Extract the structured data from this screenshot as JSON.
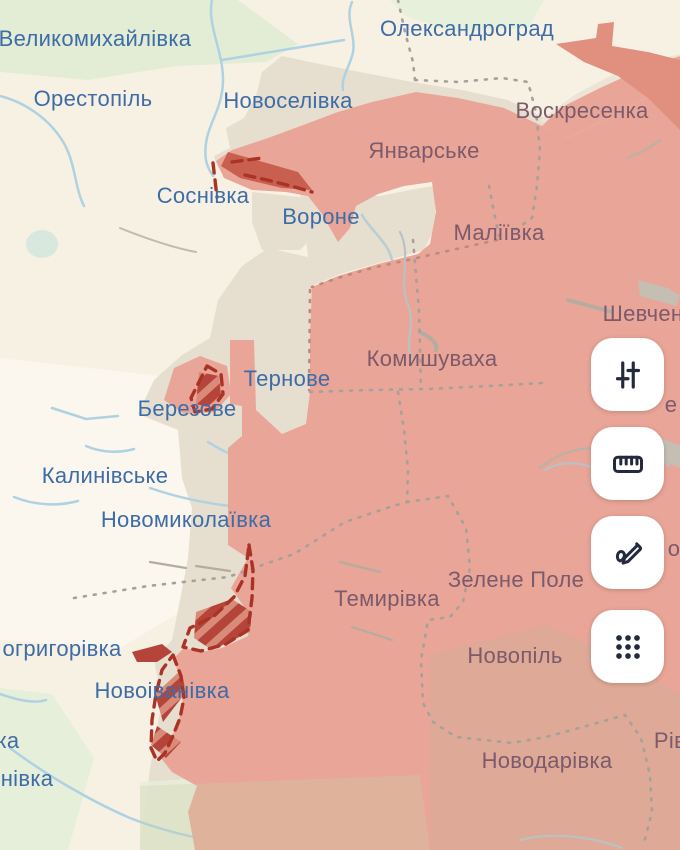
{
  "theme": {
    "cream": "#f7f1e4",
    "occupied-fill": "#e9a597",
    "occupied-dark": "#e19080",
    "advance-red": "#c9604f",
    "hatch-red": "#b5453a",
    "frontline-red": "#aa3226",
    "grey-zone": "#e6decf",
    "admin-line": "#a5a19a",
    "river-blue": "#aed2e2",
    "label-free": "#3e6ca6",
    "label-occupied": "#7c5a6b"
  },
  "map": {
    "labels": [
      {
        "text": "Великомихайлівка",
        "x": 95,
        "y": 39,
        "zone": "free"
      },
      {
        "text": "Олександроград",
        "x": 467,
        "y": 29,
        "zone": "free"
      },
      {
        "text": "Орестопіль",
        "x": 93,
        "y": 99,
        "zone": "free"
      },
      {
        "text": "Новоселівка",
        "x": 288,
        "y": 101,
        "zone": "free"
      },
      {
        "text": "Воскресенка",
        "x": 582,
        "y": 111,
        "zone": "occupied"
      },
      {
        "text": "Январське",
        "x": 424,
        "y": 151,
        "zone": "occupied"
      },
      {
        "text": "Соснівка",
        "x": 203,
        "y": 196,
        "zone": "free"
      },
      {
        "text": "Вороне",
        "x": 321,
        "y": 217,
        "zone": "free"
      },
      {
        "text": "Маліївка",
        "x": 499,
        "y": 233,
        "zone": "occupied"
      },
      {
        "text": "Шевчен",
        "x": 643,
        "y": 314,
        "zone": "occupied"
      },
      {
        "text": "Комишуваха",
        "x": 432,
        "y": 359,
        "zone": "occupied"
      },
      {
        "text": "Тернове",
        "x": 287,
        "y": 379,
        "zone": "free"
      },
      {
        "text": "Березове",
        "x": 187,
        "y": 409,
        "zone": "free"
      },
      {
        "text": "е",
        "x": 671,
        "y": 405,
        "zone": "occupied"
      },
      {
        "text": "Калинівське",
        "x": 105,
        "y": 476,
        "zone": "free"
      },
      {
        "text": "Новомиколаївка",
        "x": 186,
        "y": 520,
        "zone": "free"
      },
      {
        "text": "о",
        "x": 674,
        "y": 549,
        "zone": "occupied"
      },
      {
        "text": "Зелене Поле",
        "x": 516,
        "y": 580,
        "zone": "occupied"
      },
      {
        "text": "Темирівка",
        "x": 387,
        "y": 599,
        "zone": "occupied"
      },
      {
        "text": "огригорівка",
        "x": 62,
        "y": 649,
        "zone": "free"
      },
      {
        "text": "Новопіль",
        "x": 515,
        "y": 656,
        "zone": "occupied"
      },
      {
        "text": "Новоіванівка",
        "x": 162,
        "y": 691,
        "zone": "free"
      },
      {
        "text": "ка",
        "x": 8,
        "y": 741,
        "zone": "free"
      },
      {
        "text": "Рів",
        "x": 670,
        "y": 741,
        "zone": "occupied"
      },
      {
        "text": "Новодарівка",
        "x": 547,
        "y": 761,
        "zone": "occupied"
      },
      {
        "text": "нівка",
        "x": 27,
        "y": 779,
        "zone": "free"
      }
    ]
  },
  "toolbar": {
    "buttons": [
      {
        "name": "filters",
        "icon": "sliders-icon",
        "top": 338
      },
      {
        "name": "measure",
        "icon": "ruler-icon",
        "top": 427
      },
      {
        "name": "draw",
        "icon": "draw-icon",
        "top": 516
      },
      {
        "name": "apps",
        "icon": "grid-dots-icon",
        "top": 610
      }
    ]
  }
}
